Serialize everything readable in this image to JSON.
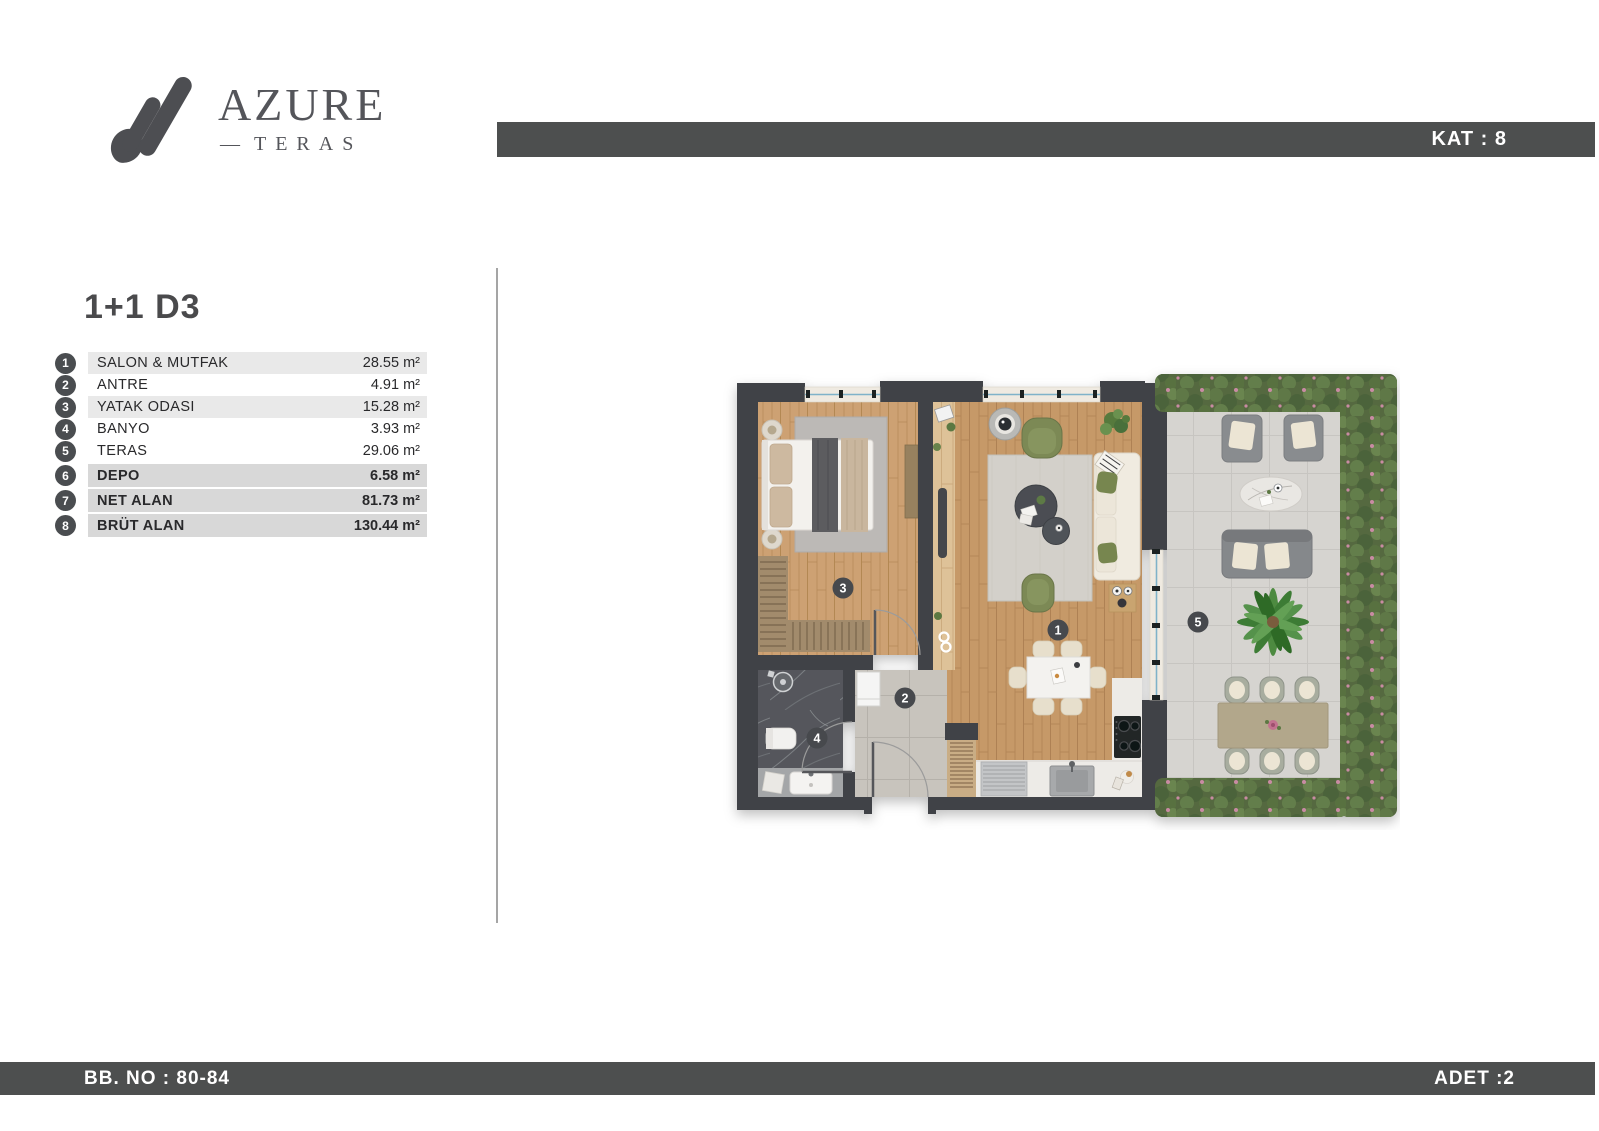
{
  "brand": {
    "name": "AZURE",
    "dash": "—",
    "tagline": "TERAS"
  },
  "header": {
    "kat": "KAT : 8"
  },
  "unit": {
    "title": "1+1 D3"
  },
  "rooms": [
    {
      "num": "1",
      "label": "SALON & MUTFAK",
      "value": "28.55 m²"
    },
    {
      "num": "2",
      "label": "ANTRE",
      "value": "4.91 m²"
    },
    {
      "num": "3",
      "label": "YATAK ODASI",
      "value": "15.28 m²"
    },
    {
      "num": "4",
      "label": "BANYO",
      "value": "3.93 m²"
    },
    {
      "num": "5",
      "label": "TERAS",
      "value": "29.06 m²"
    },
    {
      "num": "6",
      "label": "DEPO",
      "value": "6.58 m²"
    },
    {
      "num": "7",
      "label": "NET ALAN",
      "value": "81.73 m²"
    },
    {
      "num": "8",
      "label": "BRÜT ALAN",
      "value": "130.44 m²"
    }
  ],
  "footer": {
    "left": "BB. NO : 80-84",
    "right": "ADET :2"
  },
  "floorplan": {
    "badges": [
      {
        "num": "1"
      },
      {
        "num": "2"
      },
      {
        "num": "3"
      },
      {
        "num": "4"
      },
      {
        "num": "5"
      }
    ]
  },
  "colors": {
    "bar": "#4d4f4f",
    "wall": "#3f4246",
    "wood": "#c69968",
    "terrace_tile": "#d6d4d0",
    "hedge": "#55693f",
    "row_shade": "#e9e9e9",
    "row_shade_dark": "#d8d8d8",
    "window_line": "#7fb2c9",
    "armchair_green": "#7b8955"
  }
}
